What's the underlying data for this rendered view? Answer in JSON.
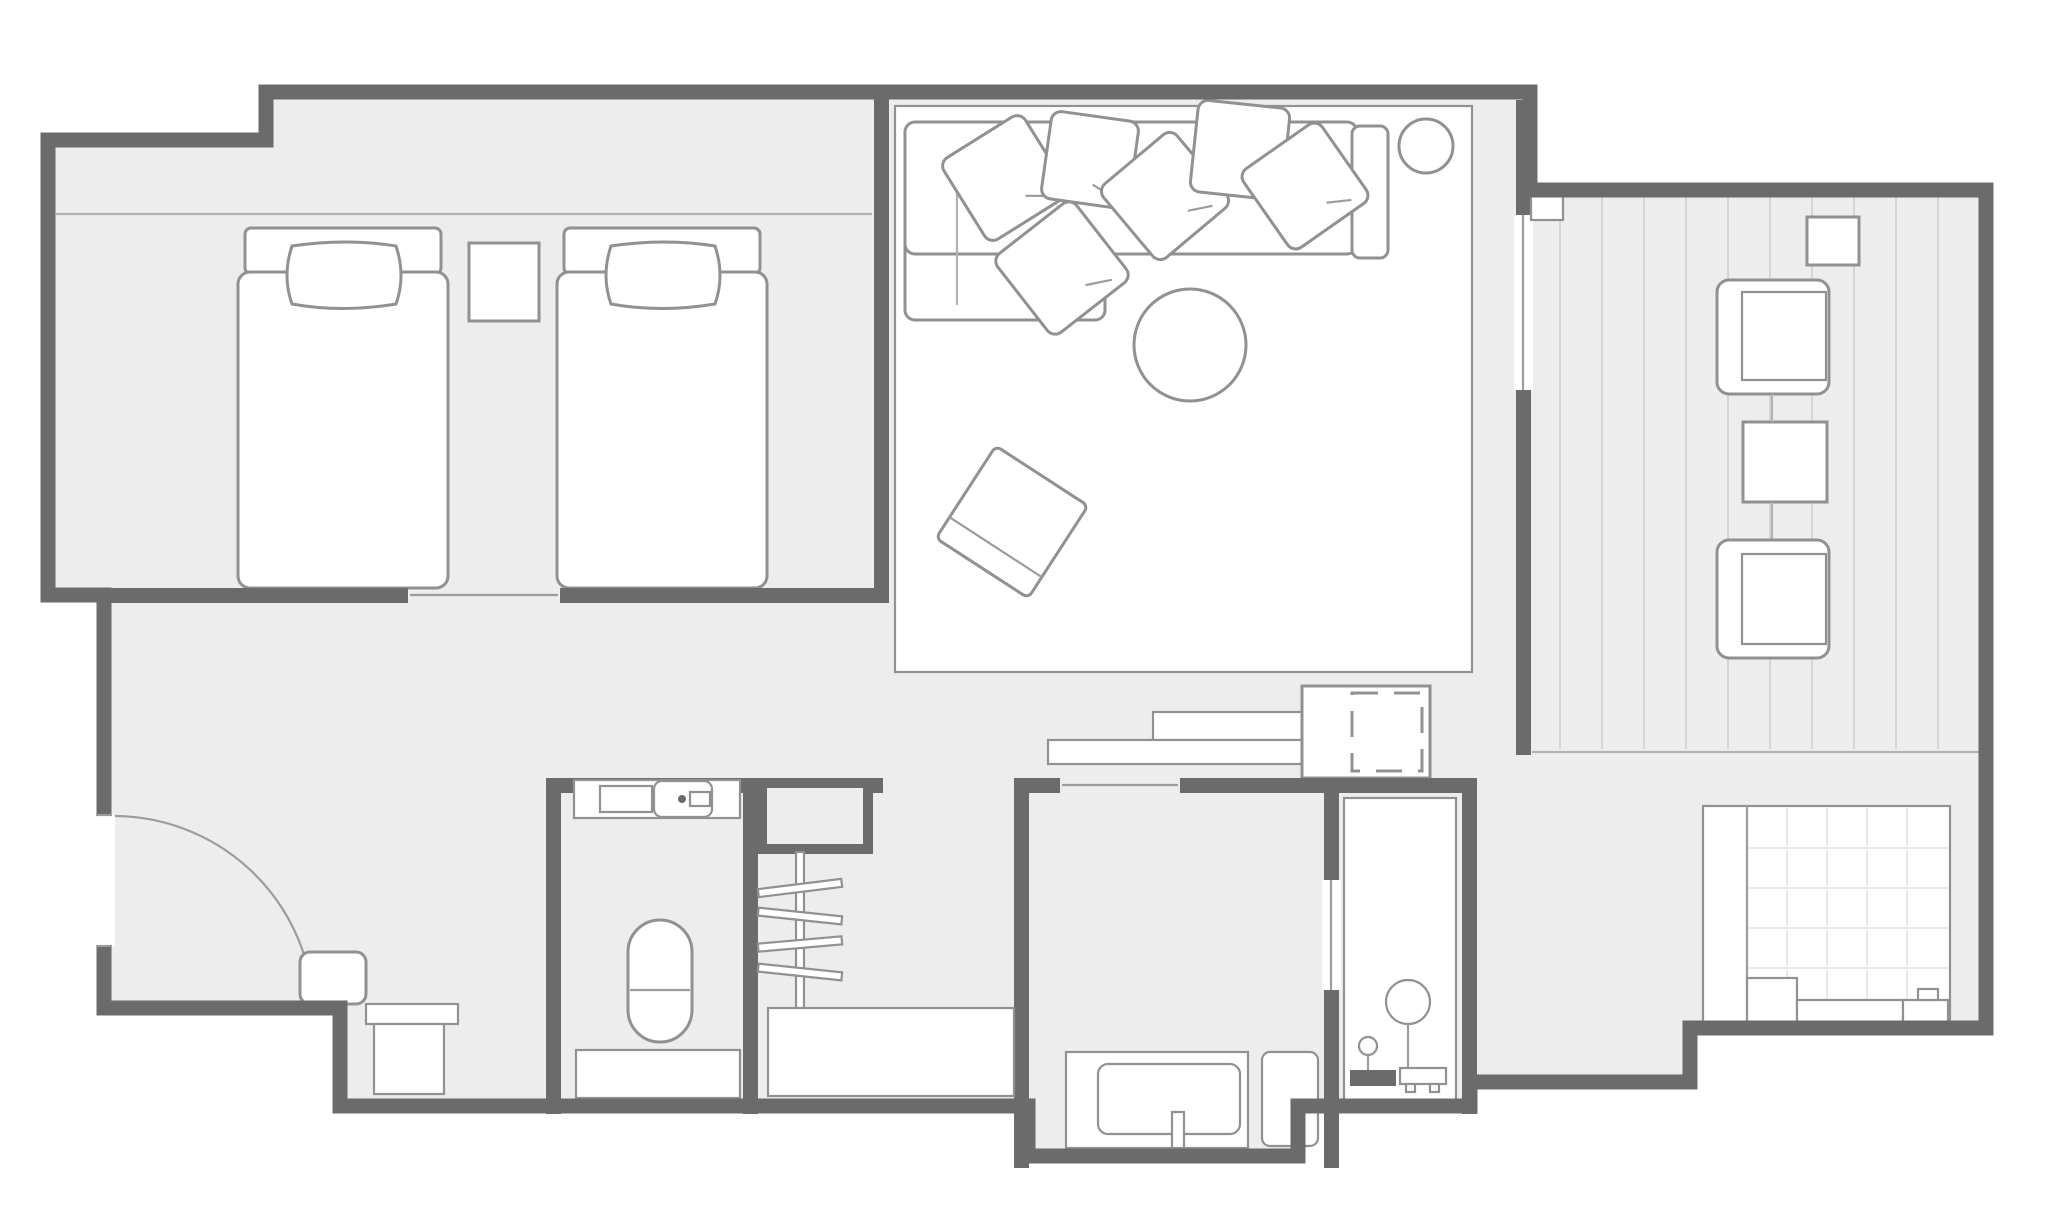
{
  "document": {
    "type": "floor-plan",
    "title": "Hotel guest room floor plan",
    "visible_text": [],
    "palette": {
      "background": "#ffffff",
      "wall": "#6b6b6b",
      "floor": "#ededee",
      "furniture_fill": "#ffffff",
      "furniture_stroke": "#8f9193",
      "balcony_stripe": "#d4d5d6",
      "tile_grid": "#e7e8e9"
    },
    "rooms": [
      {
        "name": "bedroom",
        "furniture": [
          "bed-1 (headboard, pillow, mattress)",
          "nightstand",
          "bed-2 (headboard, pillow, mattress)",
          "bulkhead-line"
        ]
      },
      {
        "name": "living-room",
        "furniture": [
          "area-rug",
          "l-shaped-sofa",
          "sofa-armrest",
          "6 scatter cushions",
          "floor-lamp (circle)",
          "round-pouf",
          "floor-cushion (rotated square)",
          "tv-console (2 low boards)",
          "cabinet with dashed appliance (mini-fridge)"
        ]
      },
      {
        "name": "balcony",
        "furniture": [
          "wood-deck-stripes",
          "side-table-small",
          "deck-chair-1",
          "deck-table",
          "deck-chair-2",
          "sliding-glass-door",
          "threshold-step"
        ]
      },
      {
        "name": "entry",
        "furniture": [
          "entrance-door-swing-arc",
          "shoe-stool",
          "luggage-bench"
        ]
      },
      {
        "name": "toilet-room",
        "furniture": [
          "vanity-counter",
          "sink-basin",
          "faucet-unit",
          "toilet",
          "lower-shelf"
        ]
      },
      {
        "name": "walk-in-closet",
        "furniture": [
          "storage-nook",
          "hanger-rail",
          "4 hangers",
          "luggage-board"
        ]
      },
      {
        "name": "washbasin-room",
        "furniture": [
          "vanity-counter",
          "wash-basin",
          "faucet",
          "side-cabinet"
        ]
      },
      {
        "name": "shower-room",
        "furniture": [
          "rain-shower-head",
          "shower-stand",
          "hand-shower-knob",
          "drain-base",
          "shower-panel"
        ]
      },
      {
        "name": "bathroom",
        "furniture": [
          "tiled-washing-area",
          "entry-step",
          "bathtub-ledge",
          "tub-end-block with faucet bump"
        ]
      }
    ]
  }
}
